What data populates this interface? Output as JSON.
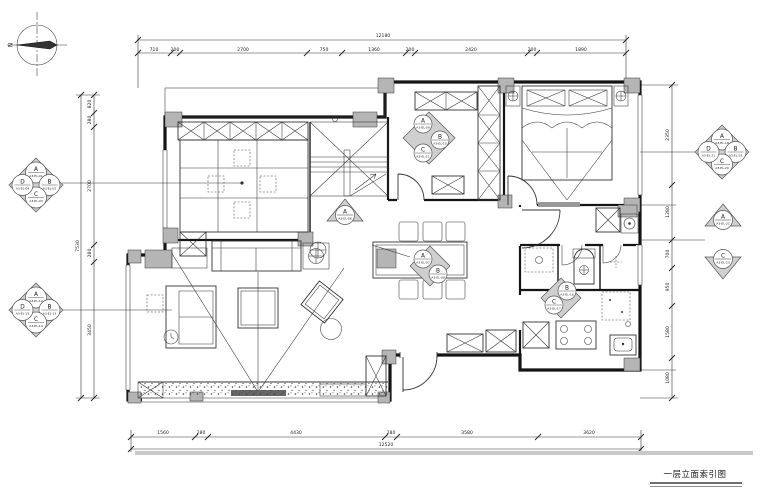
{
  "meta": {
    "title": "一层立面索引图",
    "north": "N"
  },
  "dims": {
    "top": {
      "total": "12180",
      "segs": [
        "710",
        "200",
        "2700",
        "750",
        "1360",
        "200",
        "2420",
        "200",
        "1890"
      ]
    },
    "bottom": {
      "total": "12520",
      "segs": [
        "1560",
        "280",
        "4430",
        "280",
        "3580",
        "3620"
      ]
    },
    "left": {
      "total": "7530",
      "segs": [
        "820",
        "280",
        "2700",
        "280",
        "3450"
      ]
    },
    "right": {
      "segs": [
        "2350",
        "1280",
        "700",
        "950",
        "1580",
        "1080"
      ]
    }
  },
  "markers": {
    "room_upper_left": {
      "letters": [
        "A",
        "B",
        "C",
        "D"
      ],
      "refs": [
        "A3-EL-01",
        "A3-EL-02",
        "A3-EL-03",
        "A3-EL-04"
      ]
    },
    "living": {
      "letters": [
        "A",
        "B",
        "C",
        "D"
      ],
      "refs": [
        "A3-EL-12",
        "A3-EL-13",
        "A3-EL-14",
        "A3-EL-15"
      ]
    },
    "stairs": {
      "letters": [
        "A"
      ],
      "refs": [
        "A3-EL-06"
      ]
    },
    "dining": {
      "letters": [
        "A",
        "B"
      ],
      "refs": [
        "A3-EL-07",
        "A3-EL-08"
      ]
    },
    "closet": {
      "letters": [
        "A",
        "B",
        "C"
      ],
      "refs": [
        "A3-EL-09",
        "A3-EL-10",
        "A3-EL-11"
      ]
    },
    "kitchen": {
      "letters": [
        "B",
        "C"
      ],
      "refs": [
        "A3-EL-16",
        "A3-EL-17"
      ]
    },
    "master": {
      "letters": [
        "A",
        "B",
        "C",
        "D"
      ],
      "refs": [
        "A3-EL-18",
        "A3-EL-19",
        "A3-EL-20",
        "A3-EL-21"
      ]
    },
    "right_a": {
      "letters": [
        "A"
      ],
      "refs": [
        "A3-EL-22"
      ]
    },
    "right_c": {
      "letters": [
        "C"
      ],
      "refs": [
        "A3-EL-23"
      ]
    }
  }
}
